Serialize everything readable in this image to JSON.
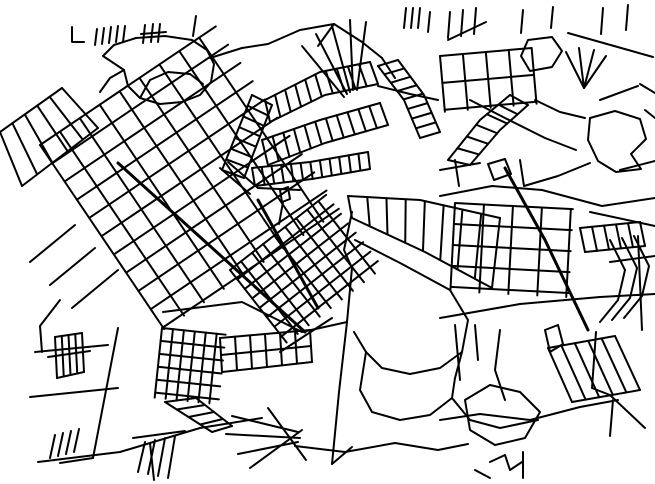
{
  "map": {
    "width": 655,
    "height": 484,
    "background": "#ffffff",
    "stroke": "#000000",
    "stroke_width": 2,
    "polylines": [
      "72,27 72,42 84,42",
      "97,29 95,45",
      "104,28 102,44",
      "111,27 109,43",
      "118,26 116,42",
      "125,26 123,42",
      "145,25 143,43",
      "153,24 151,42",
      "160,24 158,42",
      "141,34 166,32",
      "196,16 193,36",
      "103,56 114,45 136,38 165,36 192,40 207,50 214,64 211,82 200,95 182,102 160,104 140,98 128,86 124,70 112,62 103,56",
      "140,98 150,80 168,72 190,74 203,84",
      "124,70 110,78 100,92",
      "210,58 242,48 268,44 300,30",
      "300,30 334,24",
      "334,24 318,46",
      "334,24 362,42 382,58",
      "382,58 395,78",
      "350,92 332,26",
      "353,90 350,20",
      "357,90 366,22",
      "347,94 316,34",
      "344,97 302,46",
      "406,8 404,28",
      "413,8 411,28",
      "420,8 418,28",
      "430,12 428,32",
      "378,86 410,94 438,100",
      "568,33 653,57",
      "450,12 448,38",
      "463,10 461,36",
      "476,8 474,34",
      "523,10 521,33",
      "553,7 551,28",
      "603,8 601,34",
      "628,5 626,30",
      "448,40 486,22",
      "528,40 552,37 562,51 552,67 530,71 521,56 528,40",
      "584,88 566,52",
      "584,88 579,48",
      "584,88 594,50",
      "584,88 606,56",
      "470,100 505,118 545,138 576,150",
      "590,118 615,111 640,119 646,139 631,154 641,169 616,172 598,161 588,140 590,118",
      "640,84 655,93",
      "600,100 638,86",
      "645,110 655,118",
      "535,100 560,112 585,118",
      {
        "p": "440,196 492,186 542,190 602,206 655,198",
        "w": 2
      },
      {
        "p": "505,168 545,240 588,330",
        "w": 3
      },
      {
        "p": "440,318 520,304 600,297 655,294",
        "w": 2
      },
      "590,212 655,226",
      "638,236 642,330",
      "610,262 655,256",
      "610,240 625,270 618,300 600,322",
      "622,238 637,268 630,298 612,320",
      "634,236 649,266 642,296 624,318",
      "440,170 480,163",
      "455,160 459,186",
      "520,160 524,186",
      "488,164 505,159 511,174 494,180 488,164",
      "524,186 558,176 590,163",
      "620,170 655,161",
      {
        "p": "118,163 210,246 305,332",
        "w": 3
      },
      "163,312 242,302 302,332",
      "302,332 347,322",
      "280,352 332,318",
      "280,190 288,187 290,199 282,202 280,190",
      "283,202 279,224",
      "220,168 250,194",
      "228,162 258,188",
      "258,188 300,190",
      {
        "p": "258,200 318,308",
        "w": 3
      },
      "352,212 344,250 352,268 347,322",
      {
        "p": "347,322 339,392 332,464",
        "w": 2
      },
      "332,464 352,447",
      "355,240 402,264 450,290 468,320 462,352 440,368 410,374 382,368 366,352",
      "366,352 354,332",
      "366,352 360,390 372,412 400,420 430,415 452,398 455,378 462,352",
      "452,398 470,420 500,428 538,420",
      "295,446 345,452 395,443 438,450 468,444",
      "232,416 298,432",
      "226,434 300,438",
      "238,454 298,442",
      "268,408 306,460",
      "250,468 302,430",
      "221,355 311,346",
      "35,352 108,345",
      "30,397 118,388",
      "118,328 93,458",
      "38,462 120,452 200,428 262,418",
      "150,443 154,480",
      "93,458 60,463",
      "48,357 90,351",
      "55,435 50,458",
      "63,433 58,456",
      "71,431 66,454",
      "79,429 74,452",
      "133,438 185,431",
      "145,442 138,472",
      "155,440 148,474",
      "165,438 158,476",
      "175,436 168,478",
      "75,225 30,262",
      "95,248 50,285",
      "60,300 40,326 42,352",
      "118,270 72,308",
      "455,325 460,380",
      "475,325 478,360",
      "500,330 495,370 505,400",
      "545,330 558,325 563,344 550,352 545,330",
      "465,400 490,385 520,392 540,412 525,438 495,445 470,430 465,400",
      "440,420 480,414 530,420",
      "530,420 580,407 618,400",
      "610,395 645,428",
      "613,400 610,436",
      "490,462 505,455 510,470 522,462",
      "523,452 523,478",
      "475,470 490,478",
      "596,332 592,388",
      "592,388 610,395"
    ],
    "ladders": [
      {
        "a": "62,88 0,132",
        "b": "98,128 22,186",
        "n": 6
      },
      {
        "a": "265,100 320,72 370,62",
        "b": "270,122 325,95 378,84",
        "n": 11
      },
      {
        "a": "262,140 320,120 380,103",
        "b": "268,165 325,143 388,125",
        "n": 12
      },
      {
        "a": "378,66 404,100 420,138",
        "b": "398,60 424,95 440,132",
        "n": 9
      },
      {
        "a": "252,168 310,162 368,152",
        "b": "255,186 312,179 370,169",
        "n": 13
      },
      {
        "a": "348,196 420,200 500,218",
        "b": "352,218 425,252 492,288",
        "n": 9
      },
      {
        "a": "448,160 480,120 510,95",
        "b": "470,165 500,130 528,105",
        "n": 7
      },
      {
        "a": "580,228 640,222",
        "b": "585,252 645,246",
        "n": 6
      },
      {
        "a": "220,338 310,330",
        "b": "222,372 312,362",
        "n": 7
      },
      {
        "a": "548,348 615,336",
        "b": "572,402 640,390",
        "n": 6
      },
      {
        "a": "55,337 82,333",
        "b": "57,378 84,372",
        "n": 5
      },
      {
        "a": "222,170 252,95",
        "b": "244,178 272,105",
        "n": 8
      },
      {
        "a": "165,402 212,432",
        "b": "196,398 232,426",
        "n": 5
      }
    ],
    "grids": [
      {
        "x": 40,
        "y": 145,
        "angle": -34,
        "lu": 212,
        "su": 24,
        "lv": 222,
        "sv": 22
      },
      {
        "x": 230,
        "y": 270,
        "angle": -38,
        "lu": 122,
        "su": 14,
        "lv": 92,
        "sv": 12
      },
      {
        "x": 162,
        "y": 328,
        "angle": 6,
        "lu": 64,
        "su": 11,
        "lv": 70,
        "sv": 13
      },
      {
        "x": 440,
        "y": 56,
        "angle": -5,
        "lu": 92,
        "su": 23,
        "lv": 56,
        "sv": 27
      },
      {
        "x": 455,
        "y": 203,
        "angle": 3,
        "lu": 118,
        "su": 29,
        "lv": 88,
        "sv": 21
      }
    ]
  }
}
